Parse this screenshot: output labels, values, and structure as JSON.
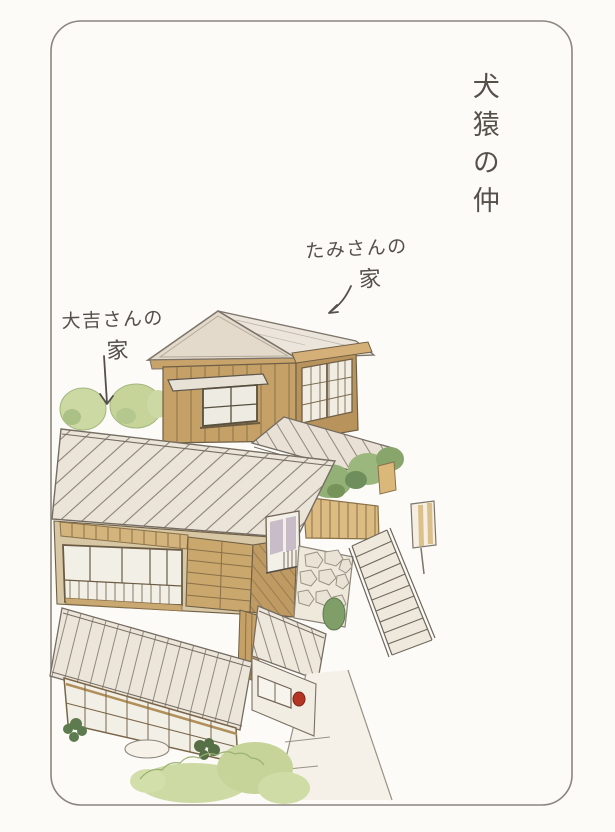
{
  "page": {
    "background": "#fcfbf8",
    "frame_color": "#8b857d"
  },
  "title": {
    "text": "犬猿の仲"
  },
  "labels": {
    "tami": {
      "line1": "たみさんの",
      "line2": "家"
    },
    "daikichi": {
      "line1": "大吉さんの",
      "line2": "家"
    }
  },
  "palette": {
    "ink": "#55504a",
    "wall_tan": "#c6a167",
    "wall_tan_dark": "#b78f58",
    "roof_light": "#ebe4d9",
    "roof_line": "#6a6158",
    "shoji_white": "#f2efe6",
    "window_frame_brown": "#7a6649",
    "bush_light": "#ccd9a2",
    "bush_mid": "#93b077",
    "bush_dark": "#5d7b4e",
    "lavender": "#c9bcc9",
    "stone": "#efe9dc",
    "red_accent": "#b43524"
  },
  "illustration": {
    "elements": [
      "tami-house",
      "daikichi-house",
      "connecting-roof",
      "wooden-fence",
      "hedge-bushes",
      "stone-wall",
      "stairs",
      "lamp-post",
      "entrance-porch",
      "footpath",
      "stepping-stone",
      "garden-bushes"
    ]
  }
}
